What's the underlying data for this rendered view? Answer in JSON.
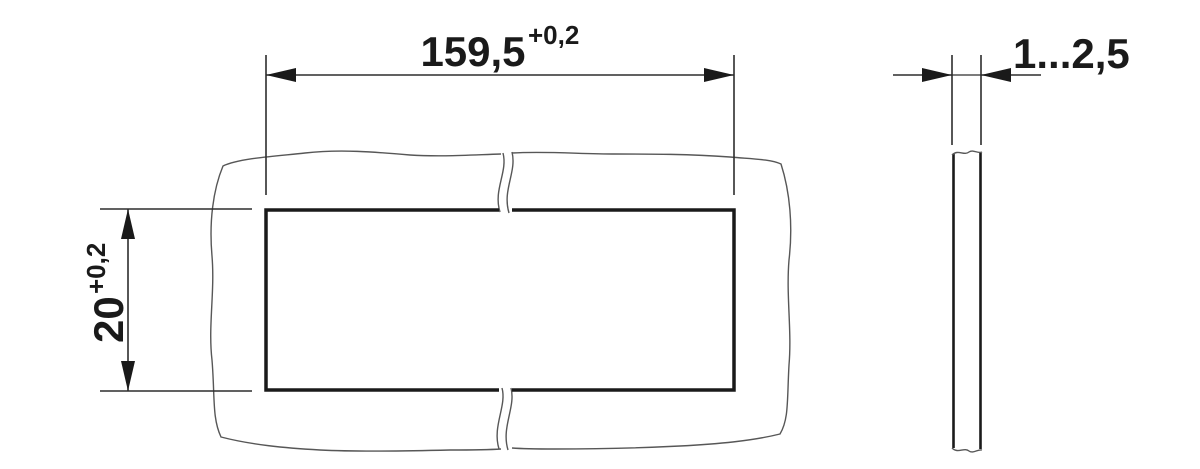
{
  "drawing": {
    "kind": "panel-cutout-dimension-drawing",
    "dimensions": {
      "cutout_width": {
        "value": "159,5",
        "tolerance": "+0,2"
      },
      "cutout_height": {
        "value": "20",
        "tolerance": "+0,2"
      },
      "panel_thickness": {
        "value": "1...2,5"
      }
    },
    "colors": {
      "background": "#ffffff",
      "heavy_line": "#1a1a1a",
      "dim_line": "#2d2d2d",
      "panel_outline": "#575757",
      "text": "#1a1a1a"
    }
  }
}
